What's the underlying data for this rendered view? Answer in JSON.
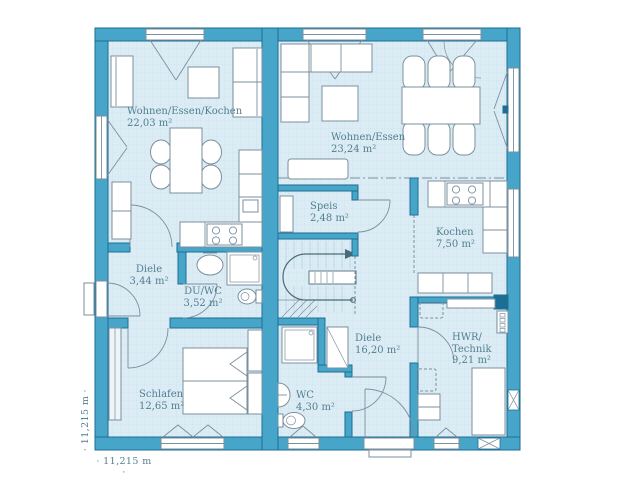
{
  "colors": {
    "wall_fill": "#47a5c9",
    "wall_outline": "#1d6e94",
    "floor_fill": "#dcecf4",
    "grid_line": "#c8dfe9",
    "furniture_stroke": "#7b909e",
    "label_text": "#527f90"
  },
  "rooms": [
    {
      "unit": "left",
      "name": "Wohnen/Essen/Kochen",
      "area": "22,03 m²"
    },
    {
      "unit": "left",
      "name": "Diele",
      "area": "3,44 m²"
    },
    {
      "unit": "left",
      "name": "DU/WC",
      "area": "3,52 m²"
    },
    {
      "unit": "left",
      "name": "Schlafen",
      "area": "12,65 m²"
    },
    {
      "unit": "right",
      "name": "Wohnen/Essen",
      "area": "23,24 m²"
    },
    {
      "unit": "right",
      "name": "Speis",
      "area": "2,48 m²"
    },
    {
      "unit": "right",
      "name": "Kochen",
      "area": "7,50 m²"
    },
    {
      "unit": "right",
      "name": "Diele",
      "area": "16,20 m²"
    },
    {
      "unit": "right",
      "name": "HWR/\nTechnik",
      "area": "9,21 m²"
    },
    {
      "unit": "right",
      "name": "WC",
      "area": "4,30 m²"
    }
  ],
  "dimensions": {
    "width_label": "· 11,215 m ·",
    "height_label": "· 11,215 m ·"
  }
}
